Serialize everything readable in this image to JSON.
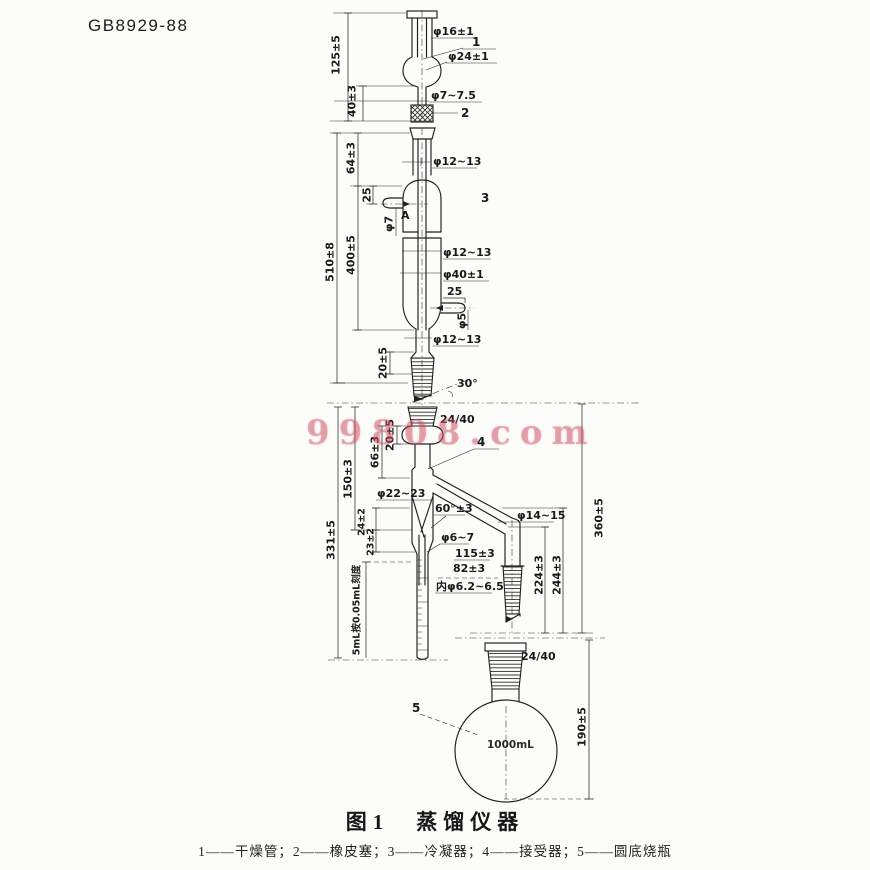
{
  "page": {
    "doc_number": "GB8929-88"
  },
  "watermark": {
    "text": "99808.com",
    "color": "#cc5062"
  },
  "figure": {
    "caption": "图1　蒸馏仪器",
    "legend": "1——干燥管；2——橡皮塞；3——冷凝器；4——接受器；5——圆底烧瓶",
    "flask_volume": "1000mL",
    "parts": {
      "p1": "1",
      "p2": "2",
      "p3": "3",
      "p4": "4",
      "p5": "5"
    },
    "dims": {
      "h125": "125±5",
      "h40": "40±3",
      "d16": "φ16±1",
      "d24": "φ24±1",
      "d7_75": "φ7~7.5",
      "h64": "64±3",
      "h510": "510±8",
      "h400": "400±5",
      "d12a": "φ12~13",
      "d12b": "φ12~13",
      "d12c": "φ12~13",
      "d40": "φ40±1",
      "arm25a": "25",
      "arm25b": "25",
      "d7": "φ7",
      "d5": "φ5",
      "ptA": "A",
      "h20a": "20±5",
      "ang30": "30°",
      "j2440a": "24/40",
      "h20b": "20±5",
      "h66": "66±3",
      "h150": "150±3",
      "h331": "331±5",
      "d22": "φ22~23",
      "ang60": "60°±3",
      "s24": "24±2",
      "s23": "23±2",
      "grad": "5mL按0.05mL刻度",
      "d6_7": "φ6~7",
      "h115": "115±3",
      "h82": "82±3",
      "din": "内φ6.2~6.5",
      "d14": "φ14~15",
      "h224": "224±3",
      "h244": "244±3",
      "h360": "360±5",
      "j2440b": "24/40",
      "h190": "190±5"
    }
  }
}
